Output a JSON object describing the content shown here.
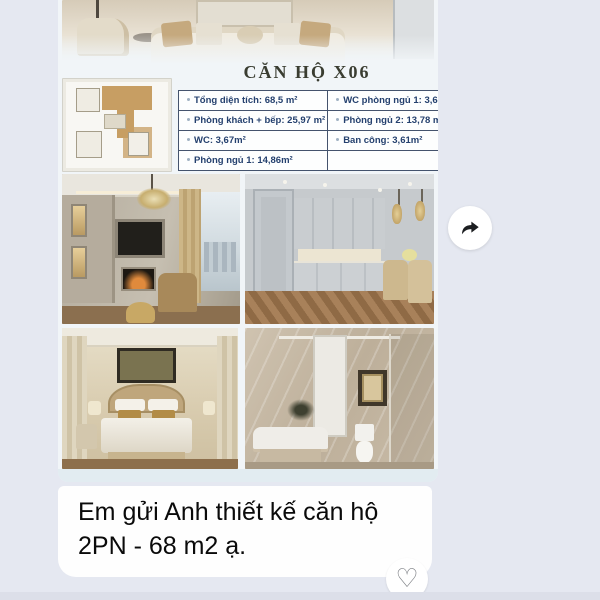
{
  "chat": {
    "background_color": "#e5e8f1",
    "bottom_bar_color": "#dcdfe9"
  },
  "card": {
    "title": "CĂN HỘ X06",
    "background_color": "#f1f5f8",
    "table": {
      "text_color": "#24406e",
      "border_color": "#44536d",
      "rows": [
        {
          "left": "Tổng diện tích: 68,5 m²",
          "right": "WC phòng ngủ 1: 3,67 m²"
        },
        {
          "left": "Phòng khách + bếp: 25,97 m²",
          "right": "Phòng ngủ 2: 13,78 m²"
        },
        {
          "left": "WC: 3,67m²",
          "right": "Ban công: 3,61m²"
        },
        {
          "left": "Phòng ngủ 1: 14,86m²",
          "right": ""
        }
      ]
    }
  },
  "message": {
    "text": "Em gửi Anh thiết kế căn hộ 2PN - 68 m2 ạ.",
    "bubble_color": "#fefefe",
    "text_color": "#0a0a0a"
  },
  "actions": {
    "forward_button": {
      "icon": "forward-arrow",
      "color": "#1c1e21"
    },
    "reaction_button": {
      "icon": "heart-outline",
      "glyph": "♡",
      "color": "#7f8287"
    }
  }
}
